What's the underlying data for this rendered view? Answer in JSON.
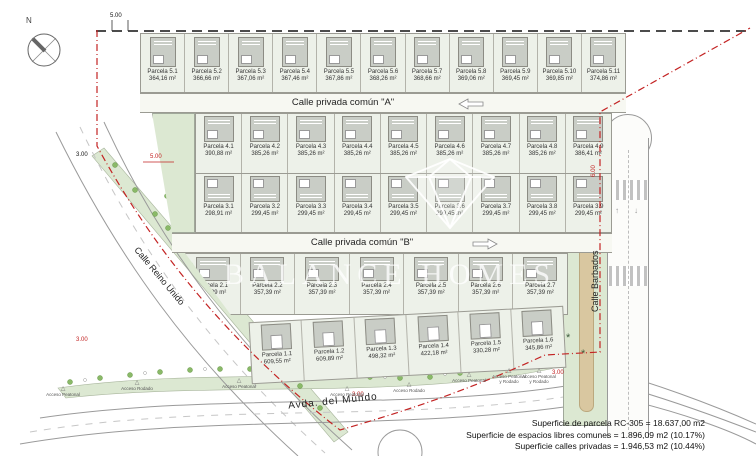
{
  "compass": {
    "north": "N"
  },
  "streets": {
    "street_a": "Calle privada común \"A\"",
    "street_b": "Calle privada común \"B\"",
    "barbados": "Calle Barbados",
    "reino_unido": "Calle Reino Unido",
    "avda": "Avda. del Mundo"
  },
  "dimensions": {
    "top": "5.00",
    "left_black": "3.00",
    "left_red": "5.00",
    "right_red": "6.00",
    "bottom_left_red": "3.00",
    "bottom_mid_red": "3.00",
    "bottom_right_red": "3.00"
  },
  "rows": {
    "row5": {
      "parcels": [
        {
          "label": "Parcela 5.1",
          "area": "364,16 m²"
        },
        {
          "label": "Parcela 5.2",
          "area": "366,66 m²"
        },
        {
          "label": "Parcela 5.3",
          "area": "367,06 m²"
        },
        {
          "label": "Parcela 5.4",
          "area": "367,46 m²"
        },
        {
          "label": "Parcela 5.5",
          "area": "367,86 m²"
        },
        {
          "label": "Parcela 5.6",
          "area": "368,26 m²"
        },
        {
          "label": "Parcela 5.7",
          "area": "368,66 m²"
        },
        {
          "label": "Parcela 5.8",
          "area": "369,06 m²"
        },
        {
          "label": "Parcela 5.9",
          "area": "369,45 m²"
        },
        {
          "label": "Parcela 5.10",
          "area": "369,85 m²"
        },
        {
          "label": "Parcela 5.11",
          "area": "374,86 m²"
        }
      ]
    },
    "row4": {
      "parcels": [
        {
          "label": "Parcela 4.1",
          "area": "390,88 m²"
        },
        {
          "label": "Parcela 4.2",
          "area": "385,26 m²"
        },
        {
          "label": "Parcela 4.3",
          "area": "385,26 m²"
        },
        {
          "label": "Parcela 4.4",
          "area": "385,26 m²"
        },
        {
          "label": "Parcela 4.5",
          "area": "385,26 m²"
        },
        {
          "label": "Parcela 4.6",
          "area": "385,26 m²"
        },
        {
          "label": "Parcela 4.7",
          "area": "385,26 m²"
        },
        {
          "label": "Parcela 4.8",
          "area": "385,26 m²"
        },
        {
          "label": "Parcela 4.9",
          "area": "386,41 m²"
        }
      ]
    },
    "row3": {
      "parcels": [
        {
          "label": "Parcela 3.1",
          "area": "298,91 m²"
        },
        {
          "label": "Parcela 3.2",
          "area": "299,45 m²"
        },
        {
          "label": "Parcela 3.3",
          "area": "299,45 m²"
        },
        {
          "label": "Parcela 3.4",
          "area": "299,45 m²"
        },
        {
          "label": "Parcela 3.5",
          "area": "299,45 m²"
        },
        {
          "label": "Parcela 3.6",
          "area": "299,45 m²"
        },
        {
          "label": "Parcela 3.7",
          "area": "299,45 m²"
        },
        {
          "label": "Parcela 3.8",
          "area": "299,45 m²"
        },
        {
          "label": "Parcela 3.9",
          "area": "299,45 m²"
        }
      ]
    },
    "row2": {
      "parcels": [
        {
          "label": "Parcela 2.1",
          "area": "377,89 m²"
        },
        {
          "label": "Parcela 2.2",
          "area": "357,39 m²"
        },
        {
          "label": "Parcela 2.3",
          "area": "357,39 m²"
        },
        {
          "label": "Parcela 2.4",
          "area": "357,39 m²"
        },
        {
          "label": "Parcela 2.5",
          "area": "357,39 m²"
        },
        {
          "label": "Parcela 2.6",
          "area": "357,39 m²"
        },
        {
          "label": "Parcela 2.7",
          "area": "357,39 m²"
        }
      ]
    },
    "row1": {
      "parcels": [
        {
          "label": "Parcela 1.1",
          "area": "609,55 m²"
        },
        {
          "label": "Parcela 1.2",
          "area": "609,89 m²"
        },
        {
          "label": "Parcela 1.3",
          "area": "498,32 m²"
        },
        {
          "label": "Parcela 1.4",
          "area": "422,18 m²"
        },
        {
          "label": "Parcela 1.5",
          "area": "330,28 m²"
        },
        {
          "label": "Parcela 1.6",
          "area": "345,86 m²"
        }
      ]
    }
  },
  "accesses": [
    {
      "label": "Acceso Peatonal"
    },
    {
      "label": "Acceso Rodado"
    },
    {
      "label": "Acceso Peatonal"
    },
    {
      "label": "Acceso Peatonal"
    },
    {
      "label": "Acceso Rodado"
    },
    {
      "label": "Acceso Peatonal"
    },
    {
      "label": "Acceso Peatonal y Rodado"
    },
    {
      "label": "Acceso Peatonal y Rodado"
    }
  ],
  "summary": {
    "lines": [
      "Superficie de parcela RC-305 = 18.637,00 m2",
      "Superficie de espacios libres comunes = 1.896,09 m2 (10.17%)",
      "Superficie calles privadas = 1.946,53 m2 (10.44%)"
    ]
  },
  "watermark": {
    "text": "BALANCE HOMES"
  },
  "colors": {
    "boundary_red": "#c32323",
    "green_strip": "#dce8d2",
    "house_gray": "#c9cdc6"
  }
}
